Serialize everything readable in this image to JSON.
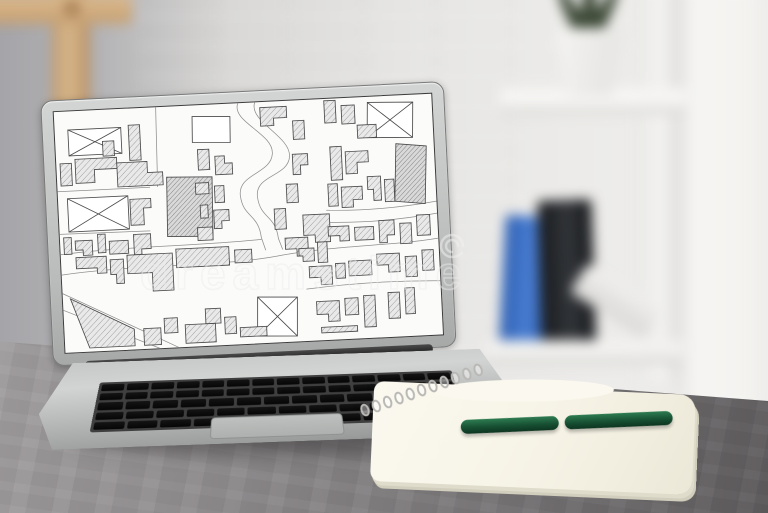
{
  "watermark": {
    "text": "dreamstime",
    "logo": "spiral"
  },
  "colors": {
    "desk": "#8b8889",
    "wall_left": "#a9a8ac",
    "wall_right": "#f4f3f1",
    "wood_frame": "#cfa97e",
    "laptop_body": "#c3c5c4",
    "keyboard_key": "#0d0d0d",
    "screen_background": "#fbfbfa",
    "map_line": "#4a4a4a",
    "map_hatch_fill": "#e3e3e3",
    "pen_green": "#1d5c3c",
    "notebook_paper": "#f7f4e8",
    "folder_blue": "#3a6ec2",
    "folder_black": "#1d1f22",
    "plant_green": "#3c4836"
  },
  "laptop": {
    "keyboard_rows": [
      14,
      14,
      13,
      12
    ],
    "keyboard_bottom_row": [
      1,
      1,
      1,
      5.5,
      1,
      1,
      1
    ],
    "coil_count": 11
  },
  "map": {
    "viewBox": "0 0 400 260",
    "buildings": [
      {
        "p": "14,20 70,20 70,48 14,48",
        "t": "c"
      },
      {
        "p": "10,94 74,94 74,130 10,130",
        "t": "c"
      },
      {
        "p": "332,6 380,8 378,46 330,44",
        "t": "c"
      },
      {
        "p": "206,210 248,212 246,254 204,252",
        "t": "c"
      },
      {
        "p": "146,12 186,14 185,42 145,40",
        "t": "p"
      },
      {
        "p": "116,76 164,78 162,142 114,140",
        "t": "d"
      },
      {
        "p": "360,52 392,56 388,118 356,114",
        "t": "d"
      },
      {
        "p": "78,18 90,18 90,56 78,56",
        "t": "h"
      },
      {
        "p": "20,52 64,52 64,64 40,64 40,78 20,78",
        "t": "h"
      },
      {
        "p": "50,34 62,34 62,50 50,50",
        "t": "h"
      },
      {
        "p": "64,58 96,58 96,70 112,70 112,84 64,84",
        "t": "h"
      },
      {
        "p": "4,56 16,56 16,80 4,80",
        "t": "h"
      },
      {
        "p": "76,98 98,98 98,108 90,108 90,126 76,126",
        "t": "h"
      },
      {
        "p": "4,136 12,136 12,154 4,154",
        "t": "h"
      },
      {
        "p": "16,140 34,140 34,156 24,156 24,150 16,150",
        "t": "h"
      },
      {
        "p": "40,134 48,134 48,154 40,154",
        "t": "h"
      },
      {
        "p": "52,142 72,142 72,156 52,156",
        "t": "h"
      },
      {
        "p": "78,136 96,136 96,152 86,152 86,158 78,158",
        "t": "h"
      },
      {
        "p": "150,48 162,48 162,70 150,70",
        "t": "h"
      },
      {
        "p": "168,56 178,56 178,64 186,64 186,76 168,76",
        "t": "h"
      },
      {
        "p": "146,84 160,84 160,96 146,96",
        "t": "h"
      },
      {
        "p": "166,88 176,88 176,106 166,106",
        "t": "h"
      },
      {
        "p": "150,108 158,108 158,122 150,122",
        "t": "h"
      },
      {
        "p": "164,114 180,114 180,126 172,126 172,134 164,134",
        "t": "h"
      },
      {
        "p": "146,132 162,132 162,146 146,146",
        "t": "h"
      },
      {
        "p": "218,6 246,6 246,18 232,18 232,26 218,26",
        "t": "h"
      },
      {
        "p": "252,22 264,22 264,42 252,42",
        "t": "h"
      },
      {
        "p": "250,58 266,58 266,70 258,70 258,80 250,80",
        "t": "h"
      },
      {
        "p": "242,90 254,90 254,110 242,110",
        "t": "h"
      },
      {
        "p": "228,116 240,116 240,138 228,138",
        "t": "h"
      },
      {
        "p": "238,148 262,148 262,168 250,168 250,160 238,160",
        "t": "h"
      },
      {
        "p": "258,124 286,124 286,154 270,154 270,146 258,146",
        "t": "h"
      },
      {
        "p": "286,2 298,2 298,26 286,26",
        "t": "h"
      },
      {
        "p": "304,8 318,8 318,28 304,28",
        "t": "h"
      },
      {
        "p": "320,30 340,30 340,44 320,44",
        "t": "h"
      },
      {
        "p": "290,52 302,52 302,88 290,88",
        "t": "h"
      },
      {
        "p": "306,58 330,58 330,70 318,70 318,82 306,82",
        "t": "h"
      },
      {
        "p": "286,92 296,92 296,116 286,116",
        "t": "h"
      },
      {
        "p": "300,96 322,96 322,110 312,110 312,118 300,118",
        "t": "h"
      },
      {
        "p": "328,86 342,86 342,112 334,112 334,100 328,100",
        "t": "h"
      },
      {
        "p": "346,90 356,90 356,114 346,114",
        "t": "h"
      },
      {
        "p": "284,138 306,138 306,154 296,154 296,148 284,148",
        "t": "h"
      },
      {
        "p": "312,140 332,140 332,154 312,154",
        "t": "h"
      },
      {
        "p": "338,134 354,134 354,150 346,150 346,158 338,158",
        "t": "h"
      },
      {
        "p": "360,138 372,138 372,160 360,160",
        "t": "h"
      },
      {
        "p": "378,130 392,130 392,152 378,152",
        "t": "h"
      },
      {
        "p": "16,158 48,158 48,176 38,176 38,170 16,170",
        "t": "h"
      },
      {
        "p": "52,162 66,162 66,188 58,188 58,178 52,178",
        "t": "h"
      },
      {
        "p": "70,158 118,158 118,198 96,198 96,178 70,178",
        "t": "h"
      },
      {
        "p": "122,154 178,154 178,174 122,174",
        "t": "h"
      },
      {
        "p": "184,158 202,158 202,172 184,172",
        "t": "h"
      },
      {
        "p": "252,160 268,160 268,174 256,174 256,168 252,168",
        "t": "h"
      },
      {
        "p": "272,154 282,154 282,176 272,176",
        "t": "h"
      },
      {
        "p": "8,202 74,238 74,256 26,256",
        "t": "h"
      },
      {
        "p": "84,238 102,238 102,256 84,256",
        "t": "h"
      },
      {
        "p": "106,228 120,228 120,244 106,244",
        "t": "h"
      },
      {
        "p": "128,236 160,236 160,256 128,256",
        "t": "h"
      },
      {
        "p": "150,220 166,220 166,236 150,236",
        "t": "h"
      },
      {
        "p": "170,230 182,230 182,248 170,248",
        "t": "h"
      },
      {
        "p": "186,242 214,242 214,252 186,252",
        "t": "h"
      },
      {
        "p": "262,180 286,180 286,200 274,200 274,192 262,192",
        "t": "h"
      },
      {
        "p": "290,178 300,178 300,194 290,194",
        "t": "h"
      },
      {
        "p": "304,176 328,176 328,192 304,192",
        "t": "h"
      },
      {
        "p": "334,170 358,170 358,190 346,190 346,182 334,182",
        "t": "h"
      },
      {
        "p": "364,174 376,174 376,196 364,196",
        "t": "h"
      },
      {
        "p": "382,168 394,168 394,190 382,190",
        "t": "h"
      },
      {
        "p": "268,218 292,218 292,240 280,240 280,232 268,232",
        "t": "h"
      },
      {
        "p": "298,216 312,216 312,234 298,234",
        "t": "h"
      },
      {
        "p": "318,214 330,214 330,248 318,248",
        "t": "h"
      },
      {
        "p": "344,212 356,212 356,240 344,240",
        "t": "h"
      },
      {
        "p": "362,208 372,208 372,236 362,236",
        "t": "h"
      },
      {
        "p": "272,246 310,246 310,252 272,252",
        "t": "h"
      }
    ],
    "roads": [
      "M195,0 C187,20 231,34 229,56 C227,78 191,76 193,100 C195,124 211,120 213,146 L217,160",
      "M213,0 C205,20 249,38 247,60 C245,82 209,78 211,102 C213,126 229,122 231,148 L235,160",
      "M0,86 L98,86",
      "M108,0 L106,86",
      "M0,132 L96,133",
      "M0,154 C70,148 150,152 213,148",
      "M0,176 C80,168 170,176 235,166 C300,158 350,162 400,156",
      "M0,196 L120,260",
      "M0,214 L100,260",
      "M283,120 Q340,124 400,116",
      "M283,133 Q340,137 400,129",
      "M258,204 Q330,198 400,202"
    ]
  }
}
